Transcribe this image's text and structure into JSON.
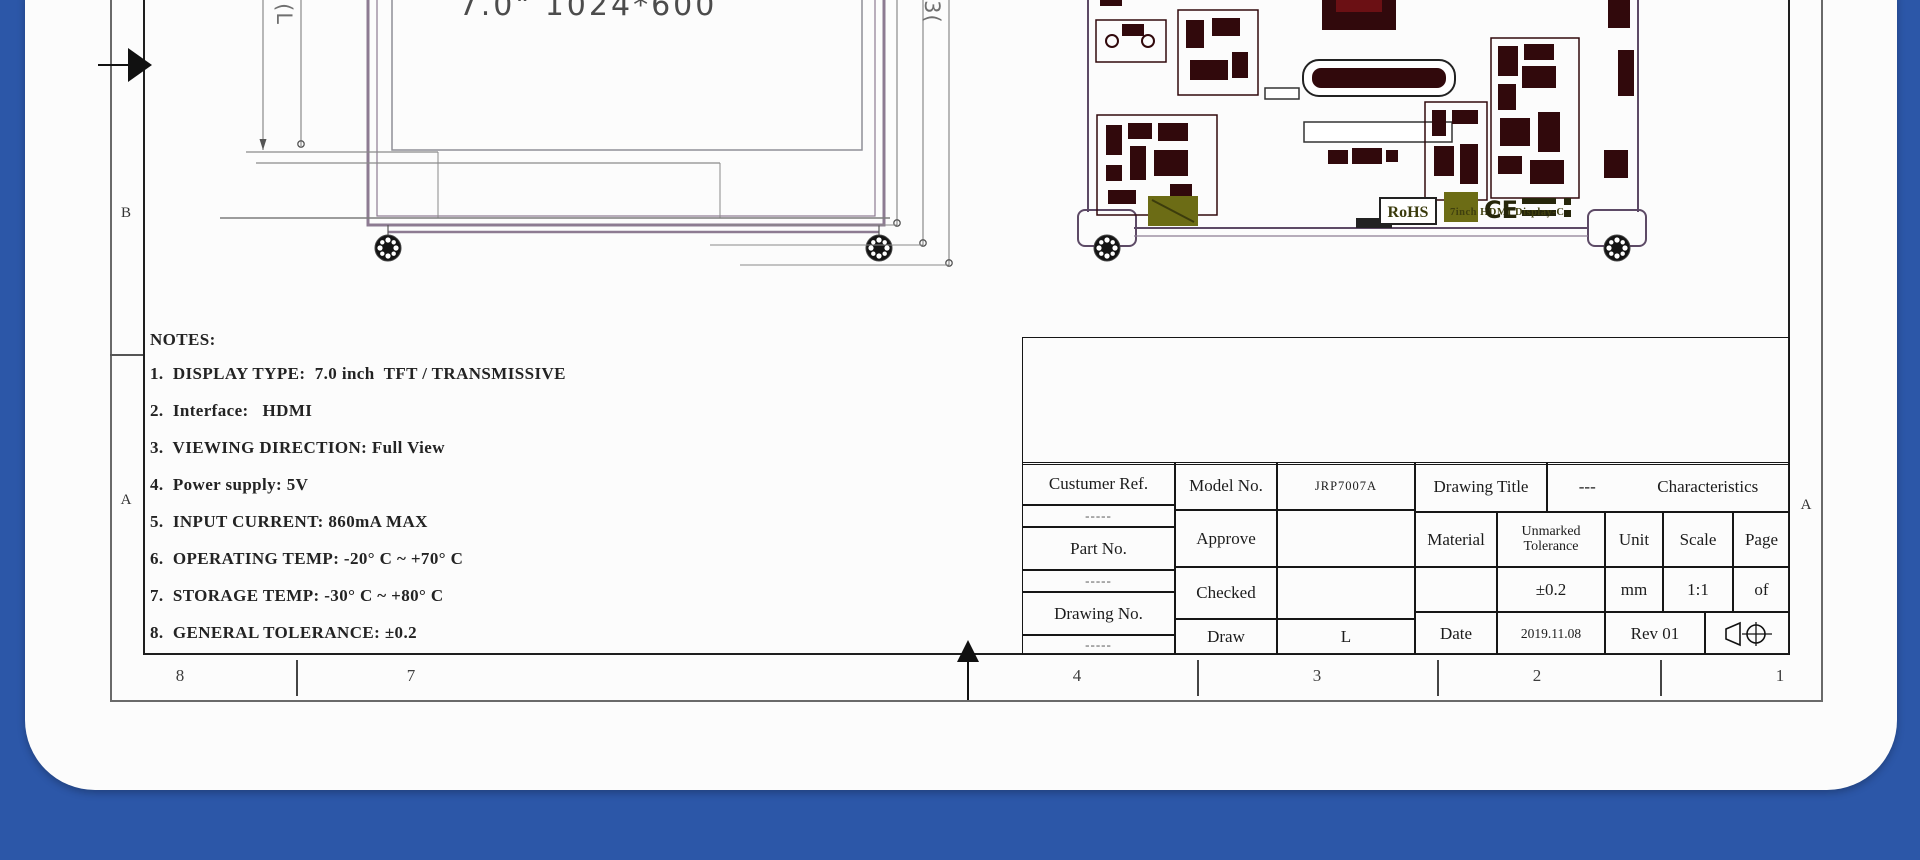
{
  "colors": {
    "background_blue": "#2c57a8",
    "card_white": "#fcfcfc",
    "pcb_component_maroon": "#31090c",
    "pcb_olive": "#6c6c15",
    "drawing_purple": "#8d7b92"
  },
  "display_drawing": {
    "screen_label": "7.0\" 1024*600",
    "dims_left": [
      "89.5",
      "85.92(L"
    ],
    "dims_right": [
      "106.8",
      "115.0",
      "120.03("
    ]
  },
  "pcb_drawing": {
    "caption": "7inch HDMI Display-C",
    "rohs_label": "RoHS",
    "ce_label": "CE"
  },
  "notes": {
    "title": "NOTES:",
    "items": [
      "1.  DISPLAY TYPE:  7.0 inch  TFT / TRANSMISSIVE",
      "2.  Interface:   HDMI",
      "3.  VIEWING DIRECTION: Full View",
      "4.  Power supply: 5V",
      "5.  INPUT CURRENT: 860mA MAX",
      "6.  OPERATING TEMP: -20° C ~ +70° C",
      "7.  STORAGE TEMP: -30° C ~ +80° C",
      "8.  GENERAL TOLERANCE: ±0.2"
    ]
  },
  "title_block": {
    "customer_ref_label": "Custumer Ref.",
    "part_no_label": "Part No.",
    "drawing_no_label": "Drawing No.",
    "dashes": "-----",
    "model_no_label": "Model No.",
    "model_no_value": "JRP7007A",
    "approve_label": "Approve",
    "checked_label": "Checked",
    "draw_label": "Draw",
    "draw_value": "L",
    "drawing_title_label": "Drawing Title",
    "drawing_title_dash": "---",
    "drawing_title_value": "Characteristics",
    "material_label": "Material",
    "unmarked_tolerance_label": "Unmarked Tolerance",
    "unit_label": "Unit",
    "scale_label": "Scale",
    "page_label": "Page",
    "tolerance_value": "±0.2",
    "unit_value": "mm",
    "scale_value": "1:1",
    "page_value": "of",
    "date_label": "Date",
    "date_value": "2019.11.08",
    "rev_value": "Rev 01"
  },
  "border": {
    "zone_b_left": "B",
    "zone_a_left": "A",
    "zone_a_right": "A",
    "ruler_zones": [
      "8",
      "7",
      "4",
      "3",
      "2",
      "1"
    ]
  }
}
